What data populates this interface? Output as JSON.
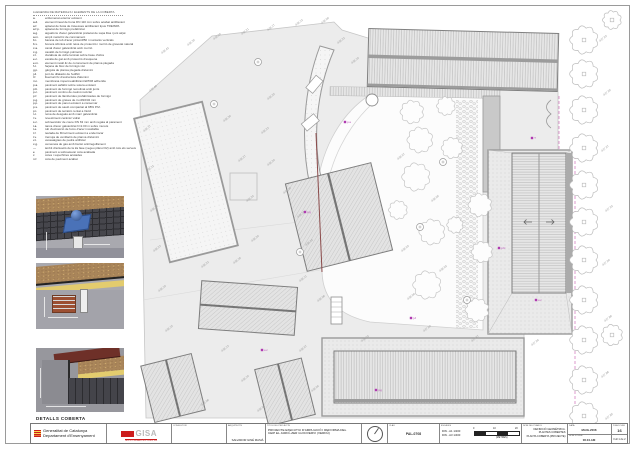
{
  "colors": {
    "senyera_red": "#cc1d1d",
    "gisa_red": "#cc1d1d",
    "magenta_boundary": "#cf6fb8",
    "maroon_line": "#8a4a4a",
    "drain_blue": "#4a72b8",
    "insulation_yellow": "#e3cc6e",
    "gravel_brown": "#a9855a",
    "coping_maroon": "#6e3028"
  },
  "details_label": "DETALLS COBERTA",
  "legend": {
    "header": "LLEGENDA DE MATERIALS I ELEMENTS DE LA COBERTA",
    "items": [
      {
        "c": "a.",
        "t": "enllumenat exterior existent"
      },
      {
        "c": "a.d.",
        "t": "element lineal de buna DN 110 mm sobre acabat antilliscant"
      },
      {
        "c": "a.f.",
        "t": "aplacat de fusta de travesses antilliscant tipus TREISPA"
      },
      {
        "c": "a.f.p.",
        "t": "aplacat de formigó prefabricat"
      },
      {
        "c": "a.g.",
        "t": "aiguafons d'acer galvanitzat prelacat de xapa llisa i junt alçat"
      },
      {
        "c": "a.m.",
        "t": "ampit metàl·lic de coronament"
      },
      {
        "c": "b.t.",
        "t": "barana de tub d'acer pintat Ø50 i muntants verticals"
      },
      {
        "c": "b.x.",
        "t": "bonera sifònica amb reixa de protecció i morrió de gravetat natural"
      },
      {
        "c": "c.a.",
        "t": "canal d'acer galvanitzat amb morrió"
      },
      {
        "c": "c.g.",
        "t": "cavalló de formigó polimèric"
      },
      {
        "c": "c.l.",
        "t": "claraboia de vidre laminat sobre base d'obra"
      },
      {
        "c": "e.c.",
        "t": "escala de gat amb protecció d'esquena"
      },
      {
        "c": "e.m.",
        "t": "element metàl·lic de coronament de planxa plegada"
      },
      {
        "c": "f.c.",
        "t": "façana de bloc de formigó vist"
      },
      {
        "c": "g.p.",
        "t": "gàrgola de planxa plegada d'alumini"
      },
      {
        "c": "j.d.",
        "t": "junt de dilatació de l'edifici"
      },
      {
        "c": "l.f.",
        "t": "lluernari fix d'estructura d'alumini"
      },
      {
        "c": "m.i.",
        "t": "membrana impermeabilitzant EPDM adherida"
      },
      {
        "c": "p.a.",
        "t": "paviment asfàltic sobre solera existent"
      },
      {
        "c": "p.b.",
        "t": "paviment de formigó remolinat amb junts"
      },
      {
        "c": "p.c.",
        "t": "paviment continu de cautxú reciclat"
      },
      {
        "c": "p.f.",
        "t": "paviment de llambordes prefabricades de formigó"
      },
      {
        "c": "p.g.",
        "t": "paviment de graves de riu Ø16/32 mm"
      },
      {
        "c": "p.p.",
        "t": "paviment de panot existent a conservar"
      },
      {
        "c": "p.s.",
        "t": "paviment de sauló compactat al 98% P.M."
      },
      {
        "c": "p.t.",
        "t": "paviment de terratzo rentat a l'àcid"
      },
      {
        "c": "r.c.",
        "t": "reixa de desguàs amb marc galvanitzat"
      },
      {
        "c": "r.v.",
        "t": "revestiment ceràmic vidrat"
      },
      {
        "c": "s.c.",
        "t": "sobreeixidor de coure DN 63 mm amb regata al parament"
      },
      {
        "c": "t.a.",
        "t": "tanca d'acer galvanitzat h=2.00 m sobre murets"
      },
      {
        "c": "t.e.",
        "t": "tub d'extracció de fums d'acer inoxidable"
      },
      {
        "c": "t.f.",
        "t": "teulada de fibrociment existent a enderrocar"
      },
      {
        "c": "t.v.",
        "t": "tremuja de ventilació de planxa d'alumini"
      },
      {
        "c": "v.t.",
        "t": "vessaaigües de pedra artificial"
      },
      {
        "c": "x.g.",
        "t": "xemeneia de gas amb barret antirregolfament"
      },
      {
        "c": "—",
        "t": "àmbit d'actuació de la 2a fase (vegeu plànol 02) amb tots els serveis"
      },
      {
        "c": "e",
        "t": "paviment a sobreelevar cota acabada"
      },
      {
        "c": "c",
        "t": "cotes i superfícies acotades"
      },
      {
        "c": "n.f.",
        "t": "cota de paviment acabat"
      }
    ]
  },
  "titleblock": {
    "generalitat": {
      "line1": "Generalitat  de  Catalunya",
      "line2": "Departament  d'Ensenyament"
    },
    "gisa": {
      "name": "GISA",
      "sub": "GESTIÓ D'INFRAESTRUCTURES, S.A."
    },
    "consultor_label": "CONSULTOR",
    "arquitecte_label": "ARQUITECTE",
    "arquitecte_name": "SALVADOR GINÉ MASIÀ",
    "titol_label": "TÍTOL DEL PROJECTE",
    "titol_line1": "PROJECTE EXECUTIU D'AMPLIACIÓ I REFORMA DEL",
    "titol_line2": "CEIP EL JARDÍ–ZER GUICIVERVI (VERDÚ)",
    "clau_label": "CLAU",
    "clau_value": "PAL-0708",
    "escales_label": "ESCALES",
    "escala1": "DIN - A1   1/200",
    "escala2": "DIN - A3   1/400",
    "tick0": "0",
    "tick10": "10",
    "tick20": "20",
    "metres": "(METRES)",
    "nom_label": "NOM DEL PLÀNOL",
    "nom_line1": "DEFINICIÓ GEOMÈTRICA.",
    "nom_line2": "PLANTES COBERTES",
    "nom_line3": "PLANTA COBERTA (PROJECTE)",
    "data_label": "DATA",
    "data_value": "MAIG-2008",
    "fitxer_label": "NOM FITXER",
    "fitxer_value": "06.04.AM",
    "planol_label": "PLÀNOL NÚM.",
    "planol_value": "16",
    "full_value": "Full 1 de 2"
  },
  "plan": {
    "spot_elevations": [
      {
        "x": 162,
        "y": 54,
        "v": "438.42"
      },
      {
        "x": 188,
        "y": 46,
        "v": "438.35"
      },
      {
        "x": 214,
        "y": 40,
        "v": "438.28"
      },
      {
        "x": 242,
        "y": 35,
        "v": "438.21"
      },
      {
        "x": 268,
        "y": 31,
        "v": "438.17"
      },
      {
        "x": 296,
        "y": 26,
        "v": "438.12"
      },
      {
        "x": 322,
        "y": 24,
        "v": "438.09"
      },
      {
        "x": 150,
        "y": 92,
        "v": "438.40"
      },
      {
        "x": 144,
        "y": 132,
        "v": "438.37"
      },
      {
        "x": 147,
        "y": 172,
        "v": "438.31"
      },
      {
        "x": 151,
        "y": 212,
        "v": "438.26"
      },
      {
        "x": 154,
        "y": 252,
        "v": "438.23"
      },
      {
        "x": 159,
        "y": 292,
        "v": "438.19"
      },
      {
        "x": 166,
        "y": 332,
        "v": "438.15"
      },
      {
        "x": 224,
        "y": 122,
        "v": "438.30"
      },
      {
        "x": 239,
        "y": 162,
        "v": "438.27"
      },
      {
        "x": 247,
        "y": 202,
        "v": "438.24"
      },
      {
        "x": 252,
        "y": 242,
        "v": "438.20"
      },
      {
        "x": 234,
        "y": 264,
        "v": "438.18"
      },
      {
        "x": 202,
        "y": 268,
        "v": "438.22"
      },
      {
        "x": 268,
        "y": 100,
        "v": "438.25"
      },
      {
        "x": 262,
        "y": 134,
        "v": "438.23"
      },
      {
        "x": 268,
        "y": 166,
        "v": "438.20"
      },
      {
        "x": 284,
        "y": 194,
        "v": "438.18"
      },
      {
        "x": 298,
        "y": 218,
        "v": "438.16"
      },
      {
        "x": 306,
        "y": 246,
        "v": "438.14"
      },
      {
        "x": 300,
        "y": 282,
        "v": "438.11"
      },
      {
        "x": 318,
        "y": 302,
        "v": "438.08"
      },
      {
        "x": 352,
        "y": 64,
        "v": "438.19"
      },
      {
        "x": 338,
        "y": 44,
        "v": "438.22"
      },
      {
        "x": 398,
        "y": 160,
        "v": "438.07"
      },
      {
        "x": 432,
        "y": 202,
        "v": "438.05"
      },
      {
        "x": 402,
        "y": 252,
        "v": "438.03"
      },
      {
        "x": 440,
        "y": 272,
        "v": "438.02"
      },
      {
        "x": 408,
        "y": 300,
        "v": "438.00"
      },
      {
        "x": 600,
        "y": 42,
        "v": "437.93"
      },
      {
        "x": 604,
        "y": 96,
        "v": "437.95"
      },
      {
        "x": 602,
        "y": 152,
        "v": "437.97"
      },
      {
        "x": 606,
        "y": 212,
        "v": "437.92"
      },
      {
        "x": 603,
        "y": 266,
        "v": "437.90"
      },
      {
        "x": 605,
        "y": 322,
        "v": "437.88"
      },
      {
        "x": 602,
        "y": 378,
        "v": "437.86"
      },
      {
        "x": 606,
        "y": 420,
        "v": "437.85"
      },
      {
        "x": 222,
        "y": 352,
        "v": "438.13"
      },
      {
        "x": 242,
        "y": 382,
        "v": "438.10"
      },
      {
        "x": 300,
        "y": 352,
        "v": "438.07"
      },
      {
        "x": 312,
        "y": 392,
        "v": "438.04"
      },
      {
        "x": 362,
        "y": 342,
        "v": "438.02"
      },
      {
        "x": 424,
        "y": 332,
        "v": "437.99"
      },
      {
        "x": 472,
        "y": 342,
        "v": "437.97"
      },
      {
        "x": 532,
        "y": 346,
        "v": "437.94"
      },
      {
        "x": 258,
        "y": 412,
        "v": "438.05"
      },
      {
        "x": 202,
        "y": 406,
        "v": "438.08"
      }
    ],
    "trees_garden": [
      {
        "x": 412,
        "y": 112,
        "r": 10
      },
      {
        "x": 446,
        "y": 106,
        "r": 8
      },
      {
        "x": 420,
        "y": 140,
        "r": 11
      },
      {
        "x": 452,
        "y": 148,
        "r": 9
      },
      {
        "x": 416,
        "y": 177,
        "r": 12
      },
      {
        "x": 432,
        "y": 232,
        "r": 11
      },
      {
        "x": 480,
        "y": 205,
        "r": 10
      },
      {
        "x": 482,
        "y": 252,
        "r": 9
      },
      {
        "x": 427,
        "y": 285,
        "r": 12
      },
      {
        "x": 477,
        "y": 310,
        "r": 10
      },
      {
        "x": 398,
        "y": 210,
        "r": 8
      },
      {
        "x": 455,
        "y": 225,
        "r": 7
      }
    ],
    "trees_edge": [
      {
        "x": 584,
        "y": 40,
        "r": 12
      },
      {
        "x": 584,
        "y": 74,
        "r": 12
      },
      {
        "x": 584,
        "y": 110,
        "r": 12
      },
      {
        "x": 584,
        "y": 148,
        "r": 12
      },
      {
        "x": 584,
        "y": 185,
        "r": 12
      },
      {
        "x": 584,
        "y": 222,
        "r": 12
      },
      {
        "x": 584,
        "y": 260,
        "r": 12
      },
      {
        "x": 584,
        "y": 300,
        "r": 12
      },
      {
        "x": 584,
        "y": 340,
        "r": 12
      },
      {
        "x": 584,
        "y": 380,
        "r": 12
      },
      {
        "x": 584,
        "y": 416,
        "r": 12
      },
      {
        "x": 612,
        "y": 20,
        "r": 8
      },
      {
        "x": 612,
        "y": 335,
        "r": 9
      }
    ],
    "drains": [
      {
        "x": 214,
        "y": 104
      },
      {
        "x": 258,
        "y": 62
      },
      {
        "x": 300,
        "y": 252
      },
      {
        "x": 420,
        "y": 227
      },
      {
        "x": 443,
        "y": 162
      },
      {
        "x": 467,
        "y": 300
      }
    ],
    "markers": [
      {
        "x": 532,
        "y": 138,
        "t": "T"
      },
      {
        "x": 305,
        "y": 212,
        "t": "p.g"
      },
      {
        "x": 262,
        "y": 350,
        "t": "e.c"
      },
      {
        "x": 411,
        "y": 318,
        "t": "j.d"
      },
      {
        "x": 499,
        "y": 248,
        "t": "p.fc"
      },
      {
        "x": 345,
        "y": 122,
        "t": "p.a"
      },
      {
        "x": 376,
        "y": 390,
        "t": "p.g"
      },
      {
        "x": 536,
        "y": 300,
        "t": "e.c"
      }
    ]
  }
}
